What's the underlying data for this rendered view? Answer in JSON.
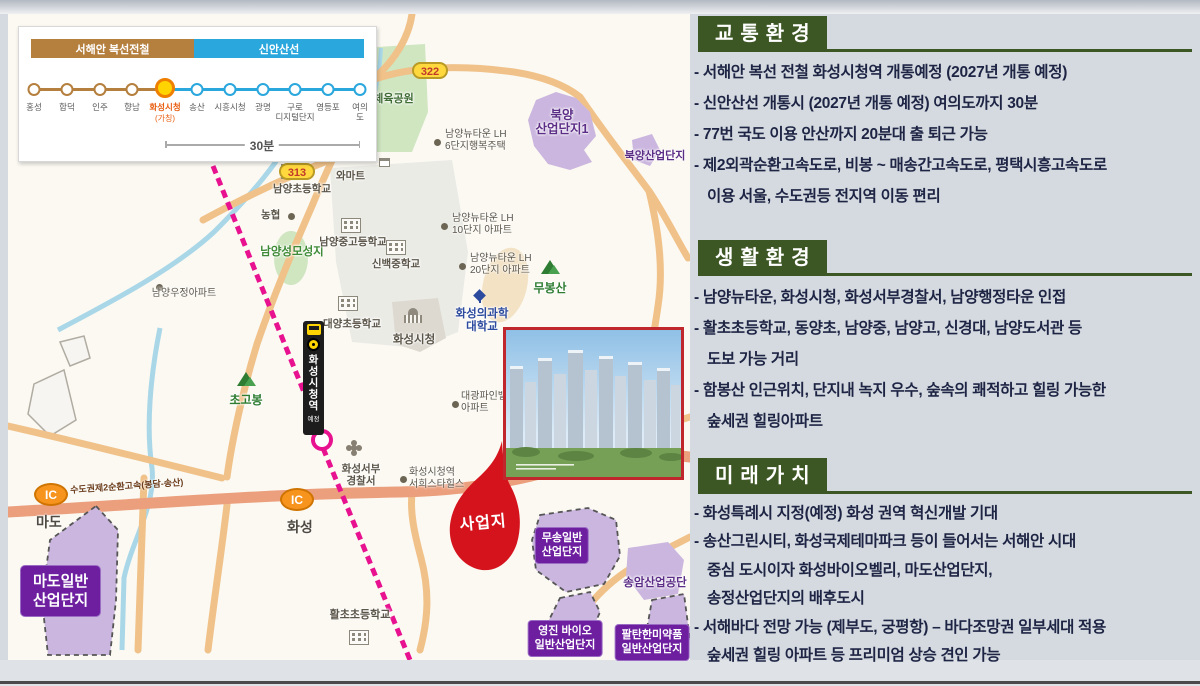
{
  "rail_diagram": {
    "line1_label": "서해안 복선전철",
    "line2_label": "신안산선",
    "duration": "30분",
    "highlight_sub": "(가칭)",
    "stations": [
      "홍성",
      "합덕",
      "인주",
      "향남",
      "화성시청",
      "송산",
      "시흥시청",
      "광명",
      "구로\n디지털단지",
      "영등포",
      "여의도"
    ]
  },
  "map": {
    "road_badge_322": "322",
    "road_badge_313": "313",
    "ic_label": "IC",
    "ic_mado": "마도",
    "ic_hwaseong": "화성",
    "highway_name": "수도권제2순환고속(봉담-송산)",
    "station_banner_title": "화성시청역",
    "station_banner_sub": "예정",
    "site_label": "사업지",
    "labels": {
      "sports_park": "남양체육공원",
      "lh6": "남양뉴타운 LH\n6단지행복주택",
      "lh10": "남양뉴타운 LH\n10단지 아파트",
      "lh20": "남양뉴타운 LH\n20단지 아파트",
      "bukyang1": "북양\n산업단지1",
      "bukyang2": "북양산업단지",
      "namyang_elem": "남양초등학교",
      "mart": "와마트",
      "nonghyup": "농협",
      "shrine": "남양성모성지",
      "namyang_mid_high": "남양중고등학교",
      "sinbaek_mid": "신백중학교",
      "woojung_apt": "남양우정아파트",
      "daeyang_elem": "대양초등학교",
      "city_hall": "화성시청",
      "univ": "화성의과학\n대학교",
      "mubongsan": "무봉산",
      "chogobong": "초고봉",
      "daegwang_apt": "대광파인밸리\n아파트",
      "police": "화성서부\n경찰서",
      "seohee_apt": "화성시청역\n서희스타힐스",
      "hwalcho_elem": "활초초등학교",
      "songam": "송암산업공단",
      "musong_box": "무송일반\n산업단지",
      "youngjin_box": "영진 바이오\n일반산업단지",
      "paltan_box": "팔탄한미약품\n일반산업단지",
      "mado_box": "마도일반\n산업단지"
    }
  },
  "sections": [
    {
      "title": "교통환경",
      "lines": [
        "- 서해안 복선 전철 화성시청역 개통예정 (2027년 개통 예정)",
        "- 신안산선 개통시 (2027년 개통 예정) 여의도까지 30분",
        "- 77번 국도 이용 안산까지 20분대 출 퇴근 가능",
        "- 제2외곽순환고속도로, 비봉 ~ 매송간고속도로, 평택시흥고속도로",
        "이용 서울, 수도권등 전지역 이동 편리"
      ]
    },
    {
      "title": "생활환경",
      "lines": [
        "- 남양뉴타운, 화성시청, 화성서부경찰서, 남양행정타운 인접",
        "- 활초초등학교, 동양초, 남양중, 남양고, 신경대, 남양도서관 등",
        "도보 가능 거리",
        "- 함봉산 인근위치, 단지내 녹지 우수, 숲속의 쾌적하고 힐링 가능한",
        "숲세권 힐링아파트"
      ]
    },
    {
      "title": "미래가치",
      "lines": [
        "- 화성특례시 지정(예정) 화성 권역 혁신개발 기대",
        "- 송산그린시티, 화성국제테마파크 등이 들어서는 서해안 시대",
        "중심 도시이자 화성바이오벨리, 마도산업단지,",
        "송정산업단지의 배후도시",
        "- 서해바다 전망 가능 (제부도, 궁평항) – 바다조망권 일부세대 적용",
        "숲세권 힐링 아파트 등 프리미엄 상승 견인 가능"
      ]
    }
  ],
  "colors": {
    "header_green": "#3c5723",
    "accent_red": "#d5131d",
    "rail_line1": "#b57f3e",
    "rail_line2": "#2aa7dd",
    "rail_pink": "#e8118f",
    "industrial_purple": "#6d1fa0"
  }
}
